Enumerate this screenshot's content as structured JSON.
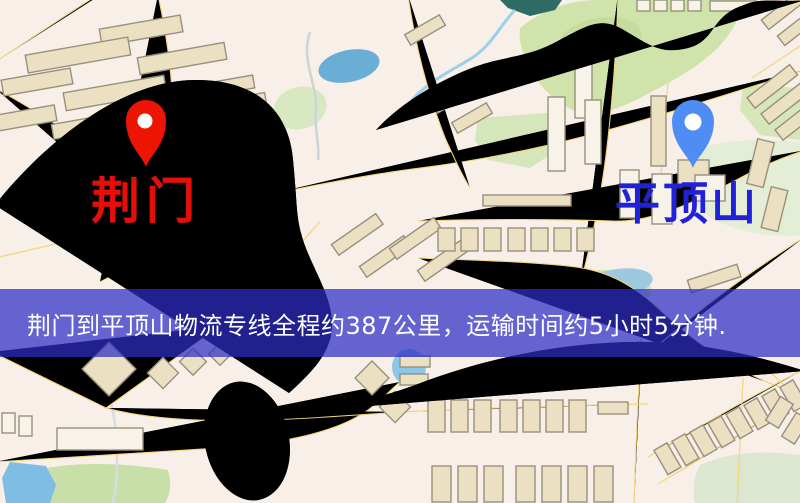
{
  "banner": {
    "text": "荆门到平顶山物流专线全程约387公里，运输时间约5小时5分钟.",
    "bg_color": "rgba(45,45,198,0.72)",
    "text_color": "#ffffff"
  },
  "markers": {
    "origin": {
      "label": "荆门",
      "pin_color": "#ee1404",
      "label_color": "#e80e08"
    },
    "destination": {
      "label": "平顶山",
      "pin_color": "#4f8df4",
      "label_color": "#2121d8"
    }
  },
  "route_info": {
    "from": "荆门",
    "to": "平顶山",
    "distance_text": "约387公里",
    "duration_text": "约5小时5分钟"
  },
  "map_palette": {
    "background": "#f8efe9",
    "road_fill": "#f5d87d",
    "road_casing": "#e3bc5e",
    "building_fill": "#ece0c3",
    "building_stroke": "#97907c",
    "park": "#cfe3ab",
    "water": "#6aaed6",
    "railway": "#2e2e2e"
  }
}
